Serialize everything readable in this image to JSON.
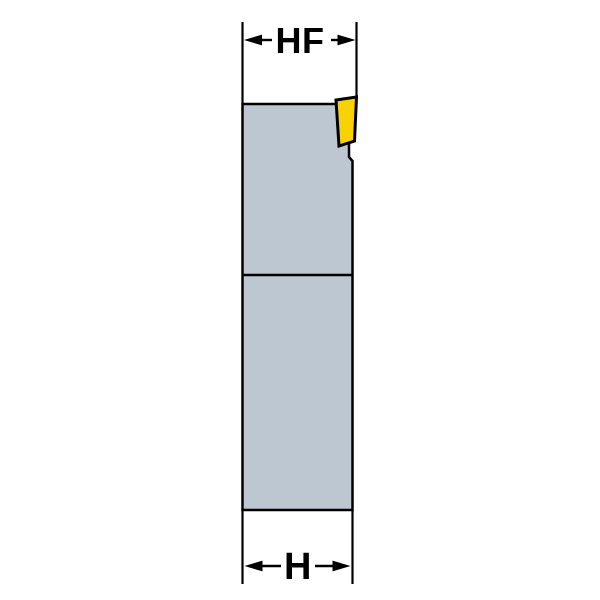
{
  "drawing": {
    "top_dimension": {
      "label": "HF"
    },
    "bottom_dimension": {
      "label": "H"
    },
    "colors": {
      "background": "#ffffff",
      "body_fill": "#bcc7d1",
      "insert_fill": "#f8d203",
      "line": "#000000"
    }
  }
}
